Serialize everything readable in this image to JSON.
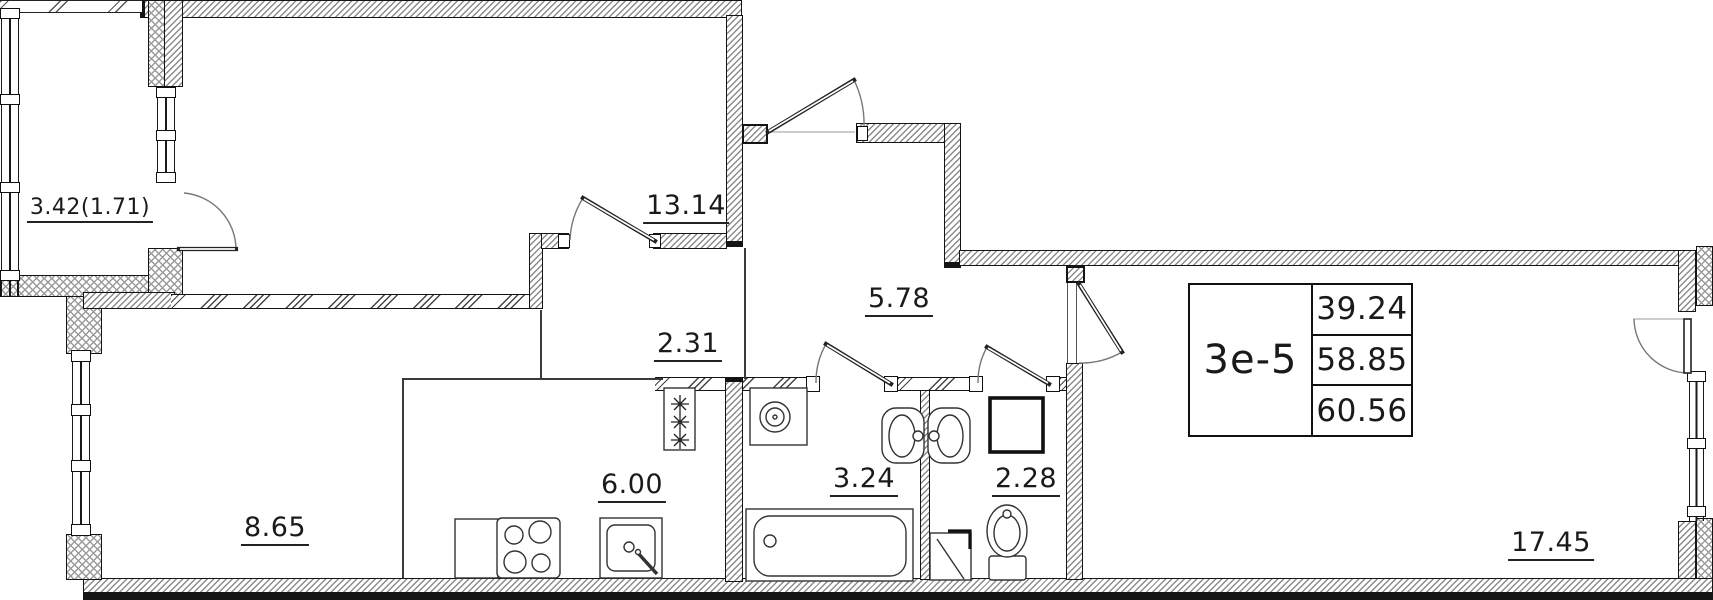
{
  "drawing": {
    "type_label": "3е-5",
    "area_values": [
      "39.24",
      "58.85",
      "60.56"
    ],
    "room_areas": {
      "balcony": "3.42(1.71)",
      "bedroom": "13.14",
      "corridor": "2.31",
      "hall": "5.78",
      "kitchen_zone": "6.00",
      "living_zone": "8.65",
      "bathroom": "3.24",
      "wc": "2.28",
      "bedroom2": "17.45"
    },
    "vent_symbol": "✳"
  }
}
